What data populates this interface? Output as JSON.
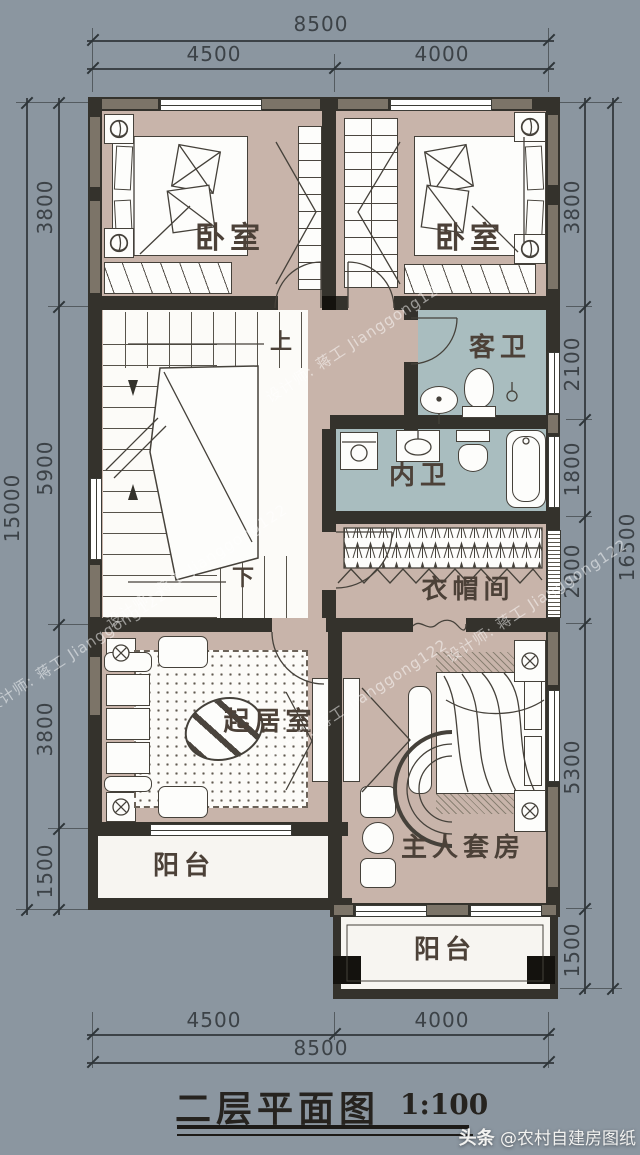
{
  "drawing": {
    "title": "二层平面图",
    "scale": "1:100"
  },
  "watermarks": {
    "designer": "设计师: 蒋工 Jianggong122",
    "brand": "头条",
    "handle": "@农村自建房图纸"
  },
  "rooms": {
    "bedroom_left": "卧室",
    "bedroom_right": "卧室",
    "guest_bath": "客卫",
    "inner_bath": "内卫",
    "cloakroom": "衣帽间",
    "living_room": "起居室",
    "master_suite": "主人套房",
    "balcony_left": "阳台",
    "balcony_right": "阳台",
    "stair_up": "上",
    "stair_down": "下"
  },
  "dimensions": {
    "top": {
      "overall": "8500",
      "segments": [
        "4500",
        "4000"
      ]
    },
    "bottom": {
      "overall": "8500",
      "segments": [
        "4500",
        "4000"
      ]
    },
    "left": {
      "overall": "15000",
      "segments": [
        "3800",
        "5900",
        "3800",
        "1500"
      ]
    },
    "right": {
      "overall": "16500",
      "segments": [
        "3800",
        "2100",
        "1800",
        "2000",
        "5300",
        "1500"
      ]
    }
  },
  "colors": {
    "background": "#8b96a0",
    "floor": "#c8b4aa",
    "bath_floor": "#a9bdbf",
    "wall": "#34322c",
    "wall_accent": "#7c7468",
    "balcony_floor": "#f7f5f1"
  }
}
